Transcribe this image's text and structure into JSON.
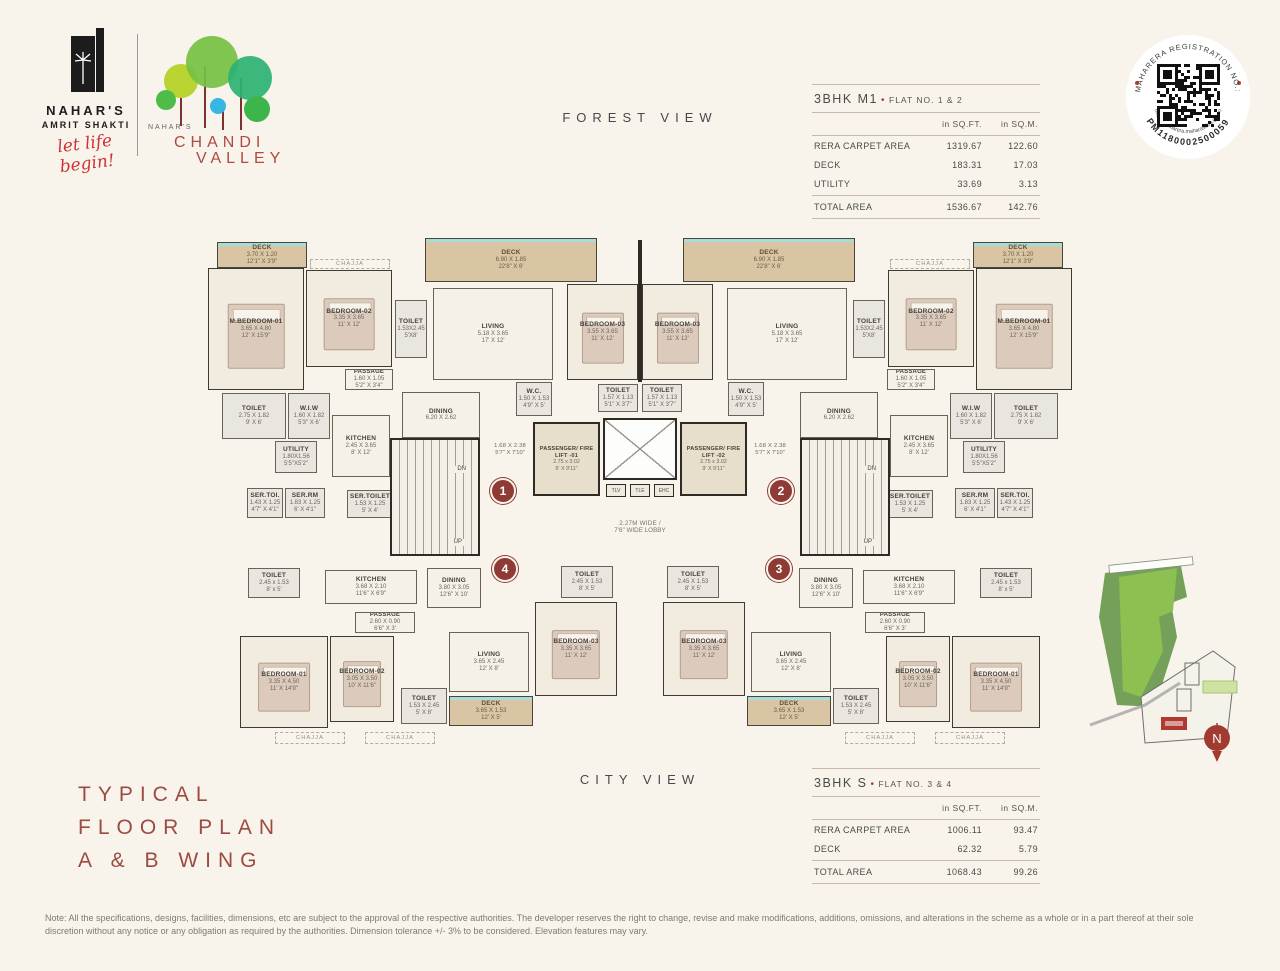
{
  "header": {
    "brand_primary": {
      "name_line1": "NAHAR'S",
      "name_line2": "AMRIT SHAKTI",
      "tagline": "let life begin!"
    },
    "brand_secondary": {
      "prefix": "NAHAR'S",
      "name_line1": "CHANDI",
      "name_line2": "VALLEY"
    },
    "view_top": "FOREST VIEW",
    "view_bottom": "CITY VIEW"
  },
  "brand_colors": {
    "maroon": "#9c4b41",
    "script_red": "#ce3136",
    "badge_red": "#8e3b35",
    "tree_green_light": "#b9d432",
    "tree_green": "#76c043",
    "tree_green_dark": "#2bb273",
    "tree_green_small": "#4fbc49",
    "tree_blue": "#35b6e3",
    "trunk_red": "#7e3230",
    "deck_tan": "#d9c5a4",
    "window_teal": "#a6dcda"
  },
  "rera_badge": {
    "arc_top": "MAHARERA REGISTRATION NO.:",
    "arc_number": "PM1180002500059",
    "arc_url": "https://maharera.maharashtra.gov.in"
  },
  "tables": [
    {
      "title": "3BHK M1",
      "bullet": "•",
      "flat": "FLAT NO. 1 & 2",
      "col1": "in SQ.FT.",
      "col2": "in SQ.M.",
      "rows": [
        [
          "RERA CARPET AREA",
          "1319.67",
          "122.60"
        ],
        [
          "DECK",
          "183.31",
          "17.03"
        ],
        [
          "UTILITY",
          "33.69",
          "3.13"
        ]
      ],
      "total": [
        "TOTAL AREA",
        "1536.67",
        "142.76"
      ]
    },
    {
      "title": "3BHK S",
      "bullet": "•",
      "flat": "FLAT NO. 3 & 4",
      "col1": "in SQ.FT.",
      "col2": "in SQ.M.",
      "rows": [
        [
          "RERA CARPET AREA",
          "1006.11",
          "93.47"
        ],
        [
          "DECK",
          "62.32",
          "5.79"
        ]
      ],
      "total": [
        "TOTAL AREA",
        "1068.43",
        "99.26"
      ]
    }
  ],
  "floorplan": {
    "width": 870,
    "stair_up": "UP",
    "stair_dn": "DN",
    "ducts": [
      "TLV",
      "TLE",
      "EHC"
    ],
    "badges": [
      {
        "n": "1",
        "x": 285,
        "y": 246
      },
      {
        "n": "2",
        "x": 563,
        "y": 246
      },
      {
        "n": "4",
        "x": 287,
        "y": 324
      },
      {
        "n": "3",
        "x": 561,
        "y": 324
      }
    ],
    "rooms": [
      {
        "id": "deck-master",
        "l1": "DECK",
        "l2": "3.70 X 1.20",
        "l3": "12'1\" X 3'9\"",
        "x": 12,
        "y": 10,
        "w": 90,
        "h": 26,
        "t": "deck",
        "mir": true
      },
      {
        "id": "chajja-top",
        "l1": "CHAJJA",
        "x": 105,
        "y": 27,
        "w": 80,
        "h": 10,
        "t": "label",
        "mir": true
      },
      {
        "id": "m-bedroom-01",
        "l1": "M.BEDROOM-01",
        "l2": "3.65 X 4.80",
        "l3": "12' X 15'9\"",
        "x": 3,
        "y": 36,
        "w": 96,
        "h": 122,
        "t": "bed",
        "mir": true
      },
      {
        "id": "bedroom-02",
        "l1": "BEDROOM-02",
        "l2": "3.35 X 3.65",
        "l3": "11' X 12'",
        "x": 101,
        "y": 38,
        "w": 86,
        "h": 97,
        "t": "bed",
        "mir": true
      },
      {
        "id": "passage-top",
        "l1": "PASSAGE",
        "l2": "1.60 X 1.05",
        "l3": "5'2\" X 3'4\"",
        "x": 140,
        "y": 137,
        "w": 48,
        "h": 21,
        "t": "small",
        "mir": true
      },
      {
        "id": "toilet-master",
        "l1": "TOILET",
        "l2": "2.75 X 1.82",
        "l3": "9' X 6'",
        "x": 17,
        "y": 161,
        "w": 64,
        "h": 46,
        "t": "wet",
        "mir": true
      },
      {
        "id": "wiw",
        "l1": "W.I.W",
        "l2": "1.60 X 1.82",
        "l3": "5'3\" X 6'",
        "x": 83,
        "y": 161,
        "w": 42,
        "h": 46,
        "t": "wet",
        "mir": true
      },
      {
        "id": "kitchen-top",
        "l1": "KITCHEN",
        "l2": "2.45 X 3.65",
        "l3": "8' X 12'",
        "x": 127,
        "y": 183,
        "w": 58,
        "h": 62,
        "t": "std",
        "mir": true
      },
      {
        "id": "utility",
        "l1": "UTILITY",
        "l2": "1.80X1.56",
        "l3": "5'5\"X5'2\"",
        "x": 70,
        "y": 209,
        "w": 42,
        "h": 32,
        "t": "wet",
        "mir": true
      },
      {
        "id": "ser-toi",
        "l1": "SER.TOI.",
        "l2": "1.43 X 1.25",
        "l3": "4'7\" X 4'1\"",
        "x": 42,
        "y": 256,
        "w": 36,
        "h": 30,
        "t": "wet",
        "mir": true
      },
      {
        "id": "ser-rm",
        "l1": "SER.RM",
        "l2": "1.83 X 1.25",
        "l3": "6' X 4'1\"",
        "x": 80,
        "y": 256,
        "w": 40,
        "h": 30,
        "t": "wet",
        "mir": true
      },
      {
        "id": "ser-toilet",
        "l1": "SER.TOILET",
        "l2": "1.53 X 1.25",
        "l3": "5' X 4'",
        "x": 142,
        "y": 258,
        "w": 46,
        "h": 28,
        "t": "wet",
        "mir": true
      },
      {
        "id": "dining-top",
        "l1": "DINING",
        "l2": "6.20 X 2.62",
        "x": 197,
        "y": 160,
        "w": 78,
        "h": 46,
        "t": "std",
        "mir": true
      },
      {
        "id": "toilet-entry",
        "l1": "TOILET",
        "l2": "1.53X2.45",
        "l3": "5'X8'",
        "x": 190,
        "y": 68,
        "w": 32,
        "h": 58,
        "t": "wet",
        "mir": true
      },
      {
        "id": "living-top",
        "l1": "LIVING",
        "l2": "5.18 X 3.65",
        "l3": "17' X 12'",
        "x": 228,
        "y": 56,
        "w": 120,
        "h": 92,
        "t": "std",
        "mir": true
      },
      {
        "id": "deck-living",
        "l1": "DECK",
        "l2": "6.90 X 1.85",
        "l3": "22'8\" X 6'",
        "x": 220,
        "y": 6,
        "w": 172,
        "h": 44,
        "t": "deck",
        "mir": true
      },
      {
        "id": "bedroom-03-top",
        "l1": "BEDROOM-03",
        "l2": "3.55 X 3.65",
        "l3": "11' X 12'",
        "x": 362,
        "y": 52,
        "w": 71,
        "h": 96,
        "t": "bed",
        "mir": true
      },
      {
        "id": "wc-top",
        "l1": "W.C.",
        "l2": "1.50 X 1.53",
        "l3": "4'9\" X 5'",
        "x": 311,
        "y": 150,
        "w": 36,
        "h": 34,
        "t": "wet",
        "mir": true
      },
      {
        "id": "toilet-center",
        "l1": "TOILET",
        "l2": "1.57 X 1.13",
        "l3": "5'1\" X 3'7\"",
        "x": 393,
        "y": 152,
        "w": 40,
        "h": 28,
        "t": "wet",
        "mir": true
      },
      {
        "id": "entry-dim",
        "l1": "1.68 X 2.38",
        "l2": "5'7\" X 7'10\"",
        "x": 280,
        "y": 208,
        "w": 50,
        "h": 20,
        "t": "dim",
        "mir": true
      },
      {
        "id": "stairs",
        "l1": "",
        "x": 185,
        "y": 206,
        "w": 90,
        "h": 118,
        "t": "stair",
        "mir": true
      },
      {
        "id": "lift-01",
        "l1": "PASSENGER/ FIRE LIFT -01",
        "l2": "2.75 x 3.02",
        "l3": "9' X 9'11\"",
        "x": 328,
        "y": 190,
        "w": 67,
        "h": 74,
        "t": "lift",
        "mir": false
      },
      {
        "id": "lift-02",
        "l1": "PASSENGER/ FIRE LIFT -02",
        "l2": "2.75 x 3.02",
        "l3": "9' X 9'11\"",
        "x": 475,
        "y": 190,
        "w": 67,
        "h": 74,
        "t": "lift",
        "mir": false
      },
      {
        "id": "lift-shaft",
        "l1": "",
        "x": 398,
        "y": 186,
        "w": 74,
        "h": 62,
        "t": "shaft",
        "mir": false
      },
      {
        "id": "lobby",
        "l1": "2.27M WIDE /",
        "l2": "7'6\" WIDE LOBBY",
        "x": 275,
        "y": 268,
        "w": 320,
        "h": 54,
        "t": "lobby",
        "mir": false
      },
      {
        "id": "toilet-b1",
        "l1": "TOILET",
        "l2": "2.45 x 1.53",
        "l3": "8' x 5'",
        "x": 43,
        "y": 336,
        "w": 52,
        "h": 30,
        "t": "wet",
        "mir": true
      },
      {
        "id": "kitchen-b",
        "l1": "KITCHEN",
        "l2": "3.68 X 2.10",
        "l3": "11'6\" X 6'9\"",
        "x": 120,
        "y": 338,
        "w": 92,
        "h": 34,
        "t": "std",
        "mir": true
      },
      {
        "id": "dining-b",
        "l1": "DINING",
        "l2": "3.80 X 3.05",
        "l3": "12'6\" X 10'",
        "x": 222,
        "y": 336,
        "w": 54,
        "h": 40,
        "t": "std",
        "mir": true
      },
      {
        "id": "toilet-b2",
        "l1": "TOILET",
        "l2": "2.45 X 1.53",
        "l3": "8' X 5'",
        "x": 356,
        "y": 334,
        "w": 52,
        "h": 32,
        "t": "wet",
        "mir": true
      },
      {
        "id": "passage-b",
        "l1": "PASSAGE",
        "l2": "2.60 X 0.90",
        "l3": "6'6\" X 3'",
        "x": 150,
        "y": 380,
        "w": 60,
        "h": 21,
        "t": "small",
        "mir": true
      },
      {
        "id": "bedroom-01-b",
        "l1": "BEDROOM-01",
        "l2": "3.35 X 4.50",
        "l3": "11' X 14'9\"",
        "x": 35,
        "y": 404,
        "w": 88,
        "h": 92,
        "t": "bed",
        "mir": true
      },
      {
        "id": "bedroom-02-b",
        "l1": "BEDROOM-02",
        "l2": "3.05 X 3.50",
        "l3": "10' X 11'6\"",
        "x": 125,
        "y": 404,
        "w": 64,
        "h": 86,
        "t": "bed",
        "mir": true
      },
      {
        "id": "toilet-b3",
        "l1": "TOILET",
        "l2": "1.53 X 2.45",
        "l3": "5' X 8'",
        "x": 196,
        "y": 456,
        "w": 46,
        "h": 36,
        "t": "wet",
        "mir": true
      },
      {
        "id": "living-b",
        "l1": "LIVING",
        "l2": "3.65 X 2.45",
        "l3": "12' X 8'",
        "x": 244,
        "y": 400,
        "w": 80,
        "h": 60,
        "t": "std",
        "mir": true
      },
      {
        "id": "deck-b",
        "l1": "DECK",
        "l2": "3.65 X 1.53",
        "l3": "12' X 5'",
        "x": 244,
        "y": 464,
        "w": 84,
        "h": 30,
        "t": "deck",
        "mir": true
      },
      {
        "id": "bedroom-03-b",
        "l1": "BEDROOM-03",
        "l2": "3.35 X 3.65",
        "l3": "11' X 12'",
        "x": 330,
        "y": 370,
        "w": 82,
        "h": 94,
        "t": "bed",
        "mir": true
      },
      {
        "id": "chajja-b1",
        "l1": "CHAJJA",
        "x": 70,
        "y": 500,
        "w": 70,
        "h": 12,
        "t": "label",
        "mir": true
      },
      {
        "id": "chajja-b2",
        "l1": "CHAJJA",
        "x": 160,
        "y": 500,
        "w": 70,
        "h": 12,
        "t": "label",
        "mir": true
      }
    ]
  },
  "site_map": {
    "compass_letter": "N"
  },
  "footer": {
    "plan_title_lines": [
      "TYPICAL",
      "FLOOR PLAN",
      "A & B WING"
    ],
    "note": "Note: All the specifications, designs, facilities, dimensions, etc are subject to the approval of the respective authorities. The developer reserves the right to change, revise and make modifications, additions, omissions, and alterations in the scheme as a whole or in a part thereof at their sole discretion without any notice or any obligation as required by the authorities. Dimension tolerance +/- 3% to be considered. Elevation features may vary."
  }
}
